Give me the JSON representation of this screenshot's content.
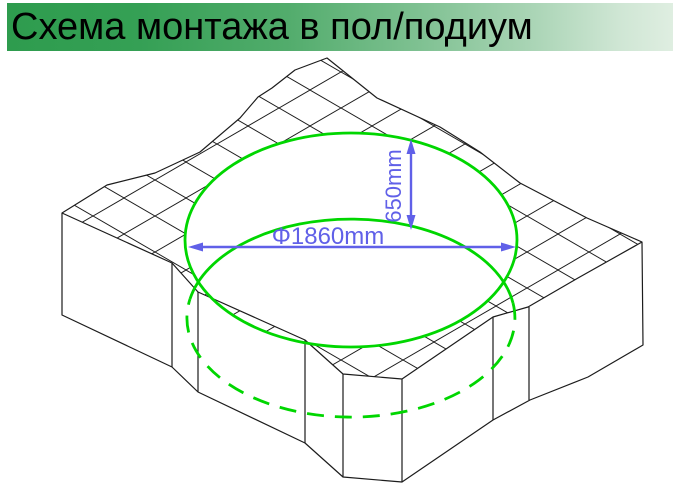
{
  "header": {
    "title": "Схема монтажа в пол/подиум",
    "bar_gradient_left": "#2E9C4E",
    "bar_gradient_right": "#DFEEE1",
    "text_color": "#000000"
  },
  "diagram": {
    "type": "isometric installation drawing of round bathtub cutout in floor/podium",
    "diameter_label": "Φ1860mm",
    "depth_label": "650mm",
    "colors": {
      "outline": "#1C1C1C",
      "cutout_circle": "#00D600",
      "dimension": "#6060E8"
    }
  }
}
